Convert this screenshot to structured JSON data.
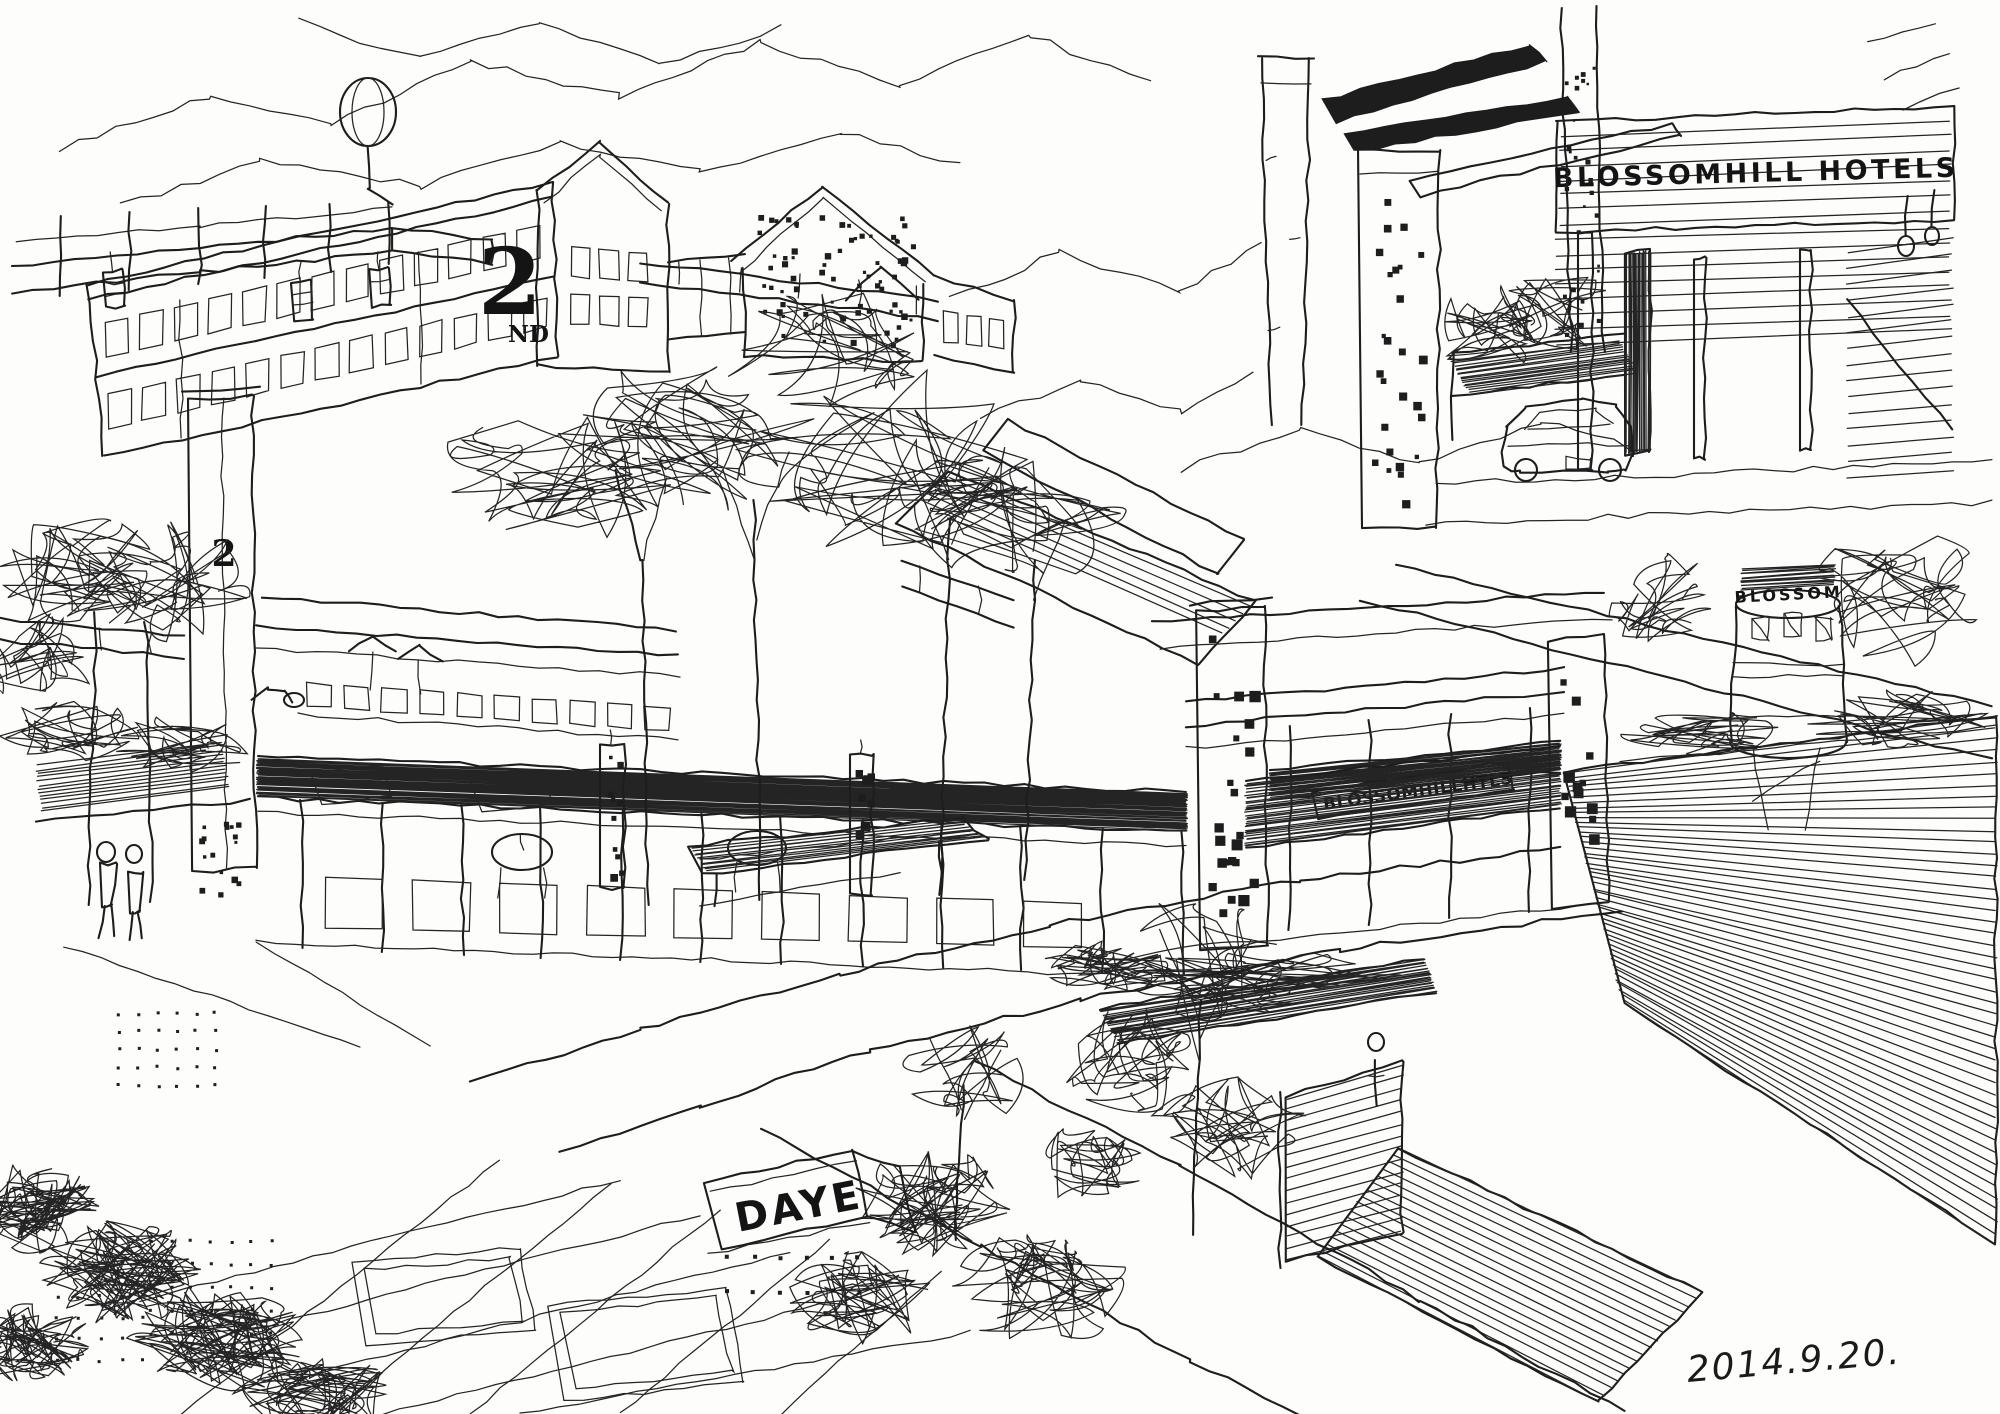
{
  "artwork": {
    "medium": "pen-and-ink architectural sketch",
    "subject": "renovated factory quarter: hotel entrance, colonnade shops, water tower, plaza and courtyards",
    "paper_color": "#fdfdfb",
    "ink_color": "#1d1d1d",
    "signature_date": "2014.9.20."
  },
  "labels": {
    "factory_number_large": "2",
    "factory_number_suffix": "ND",
    "pylon_number": "2",
    "hotel_band_sign": "BLOSSOMHILL HOTELS",
    "walkway_canopy_sign": "BLOSSOMHILLHTLS",
    "water_tower_sign": "BLOSSOM",
    "plaza_sign": "DAYE"
  }
}
